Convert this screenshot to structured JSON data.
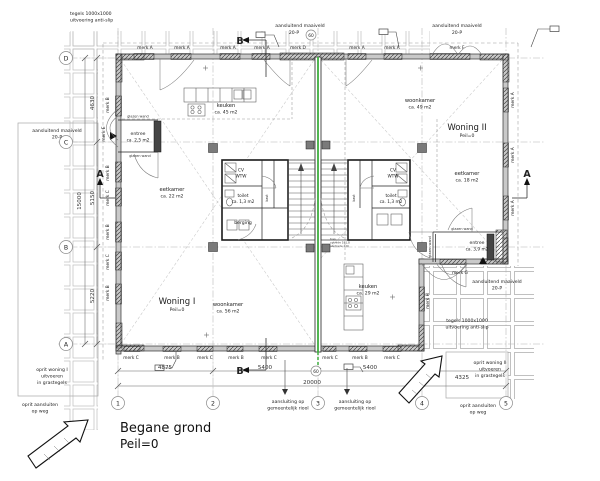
{
  "drawing": {
    "title": "Begane grond",
    "subtitle": "Peil=0"
  },
  "grid": {
    "cols": [
      "1",
      "2",
      "3",
      "4",
      "5"
    ],
    "rows": [
      "D",
      "C",
      "B",
      "A"
    ]
  },
  "dims": {
    "bottom": [
      "4875",
      "5400",
      "5400",
      "4325"
    ],
    "bottom_total": "20000",
    "left": [
      "4630",
      "5150",
      "5220"
    ],
    "left_total": "15000"
  },
  "woning1": {
    "name": "Woning I",
    "peil": "Peil=0",
    "entree": "entree",
    "entree_area": "ca. 2,5 m2",
    "keuken": "keuken",
    "keuken_area": "ca. 45 m2",
    "eetkamer": "eetkamer",
    "eetkamer_area": "ca. 22 m2",
    "woonkamer": "woonkamer",
    "woonkamer_area": "ca. 56 m2",
    "cv": "CV",
    "wtw": "WTW",
    "toilet": "toilet",
    "toilet_area": "ca. 1,3 m2",
    "berging": "berging",
    "kast": "kast"
  },
  "woning2": {
    "name": "Woning II",
    "peil": "Peil=0",
    "entree": "entree",
    "entree_area": "ca. 3,9 m2",
    "keuken": "keuken",
    "keuken_area": "ca. 29 m2",
    "eetkamer": "eetkamer",
    "eetkamer_area": "ca. 18 m2",
    "woonkamer": "woonkamer",
    "woonkamer_area": "ca. 49 m2",
    "cv": "CV",
    "wtw": "WTW",
    "toilet": "toilet",
    "toilet_area": "ca. 1,3 m2",
    "kast": "kast"
  },
  "merk": {
    "top": [
      "merk A",
      "merk A",
      "merk A",
      "merk A",
      "merk D",
      "merk A",
      "merk A",
      "merk F"
    ],
    "left": [
      "merk B",
      "merk E",
      "merk B",
      "merk C",
      "merk B",
      "merk C",
      "merk B"
    ],
    "bottom": [
      "merk C",
      "merk B",
      "merk C",
      "merk B",
      "merk C",
      "merk C",
      "merk B",
      "merk C"
    ],
    "right": [
      "merk A",
      "merk A",
      "merk A"
    ],
    "g": "merk G",
    "h": "merk H"
  },
  "notes": {
    "tiles1": "tegels 1000x1000",
    "tiles2": "uitvoering anti-slip",
    "maaiveld1": "aansluitend maaiveld",
    "maaiveld2": "20-P",
    "sewer1": "aansluiting op",
    "sewer2": "gemeentelijk riool",
    "oprit1_1": "oprit woning I",
    "oprit2_1": "oprit woning II",
    "oprit_2": "uitvoeren",
    "oprit_3": "in grastegels",
    "opritweg1": "oprit aansluiten",
    "opritweg2": "op weg",
    "glazenwand": "glazen wand",
    "c60": "60",
    "secA": "A",
    "secB": "B",
    "trap1": "trap",
    "trap2": "optrede 191,8",
    "trap3": "aantrede 220"
  },
  "colors": {
    "party_wall": "#3fae3f"
  }
}
